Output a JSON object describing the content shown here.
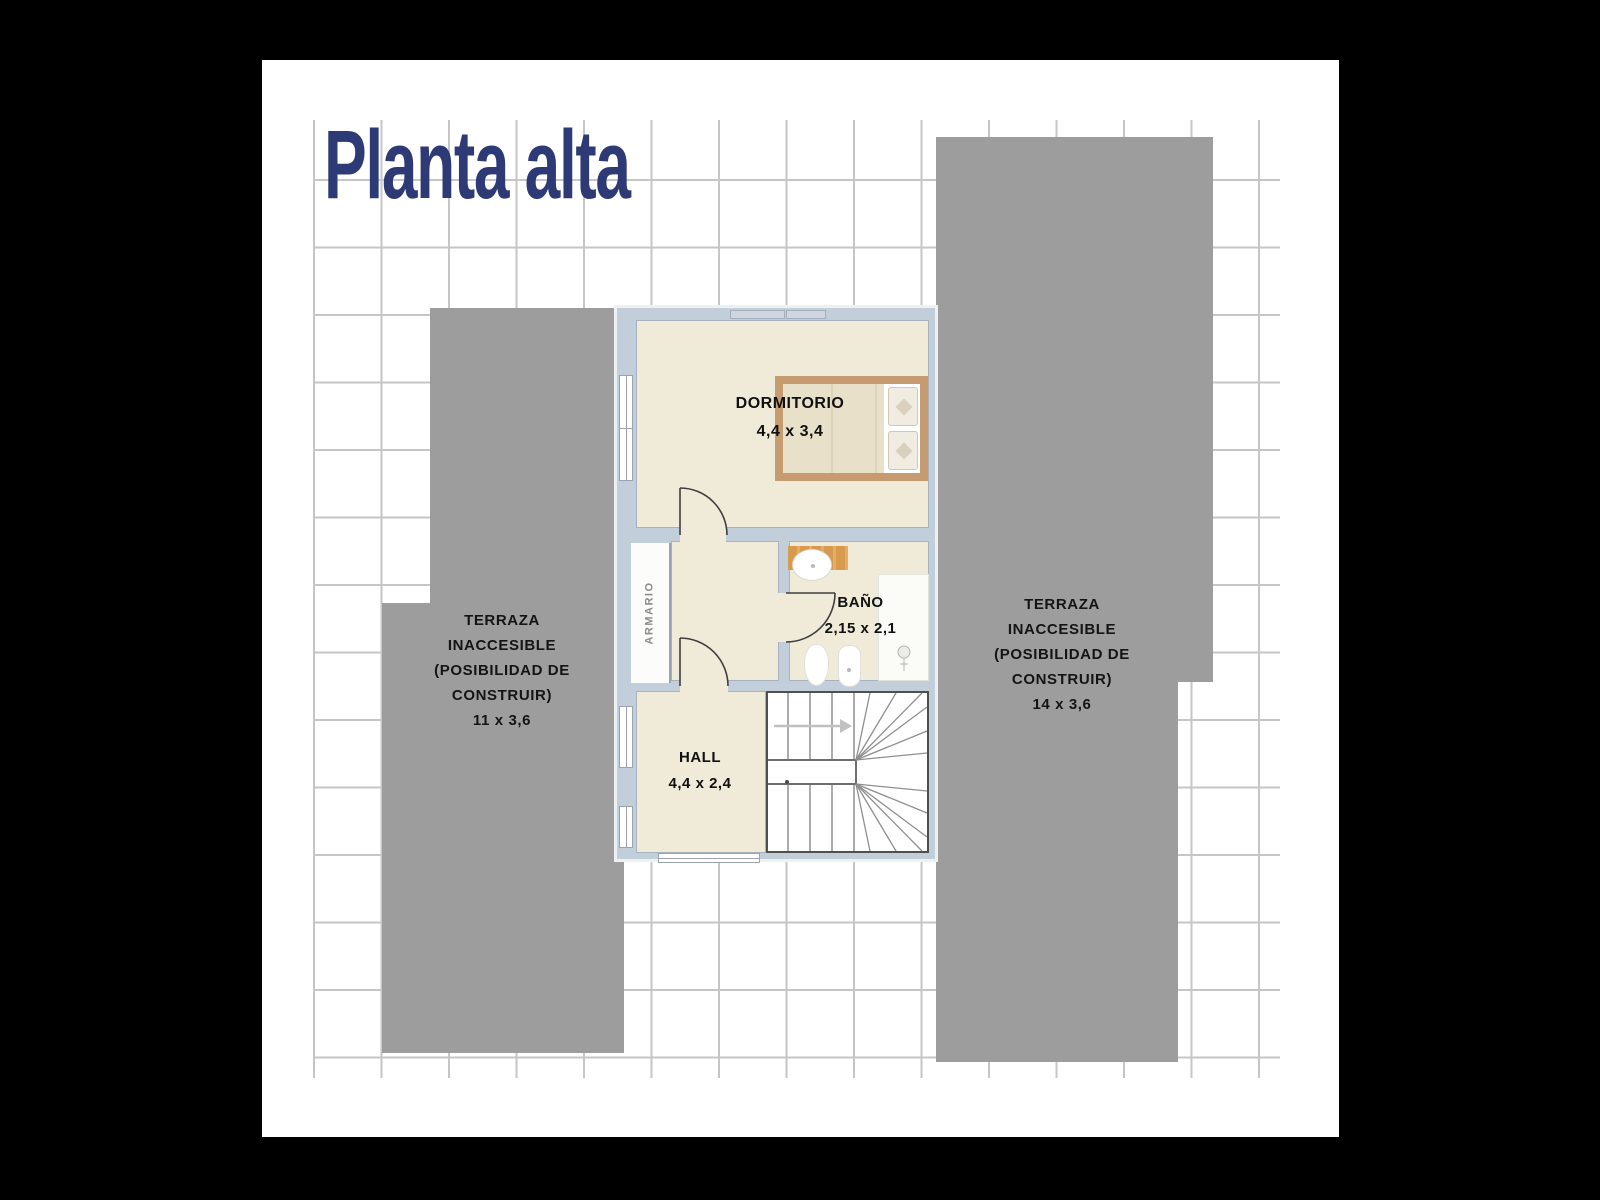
{
  "page": {
    "title": "Planta alta"
  },
  "terraces": {
    "left": {
      "lines": [
        "TERRAZA",
        "INACCESIBLE",
        "(POSIBILIDAD DE",
        "CONSTRUIR)",
        "11 x 3,6"
      ]
    },
    "right": {
      "lines": [
        "TERRAZA",
        "INACCESIBLE",
        "(POSIBILIDAD DE",
        "CONSTRUIR)",
        "14 x 3,6"
      ]
    }
  },
  "rooms": {
    "dormitorio": {
      "name": "DORMITORIO",
      "dims": "4,4 x 3,4"
    },
    "bano": {
      "name": "BAÑO",
      "dims": "2,15 x 2,1"
    },
    "hall": {
      "name": "HALL",
      "dims": "4,4 x 2,4"
    },
    "armario": {
      "name": "ARMARIO"
    }
  },
  "colors": {
    "title_navy": "#2d3a76",
    "terrace_gray": "#9d9d9d",
    "wall": "#c3cedb",
    "floor_cream": "#f0ead9",
    "grid_line": "#c6c6c6",
    "bed_frame": "#c59b6f",
    "counter_wood": "#d89a4e"
  }
}
